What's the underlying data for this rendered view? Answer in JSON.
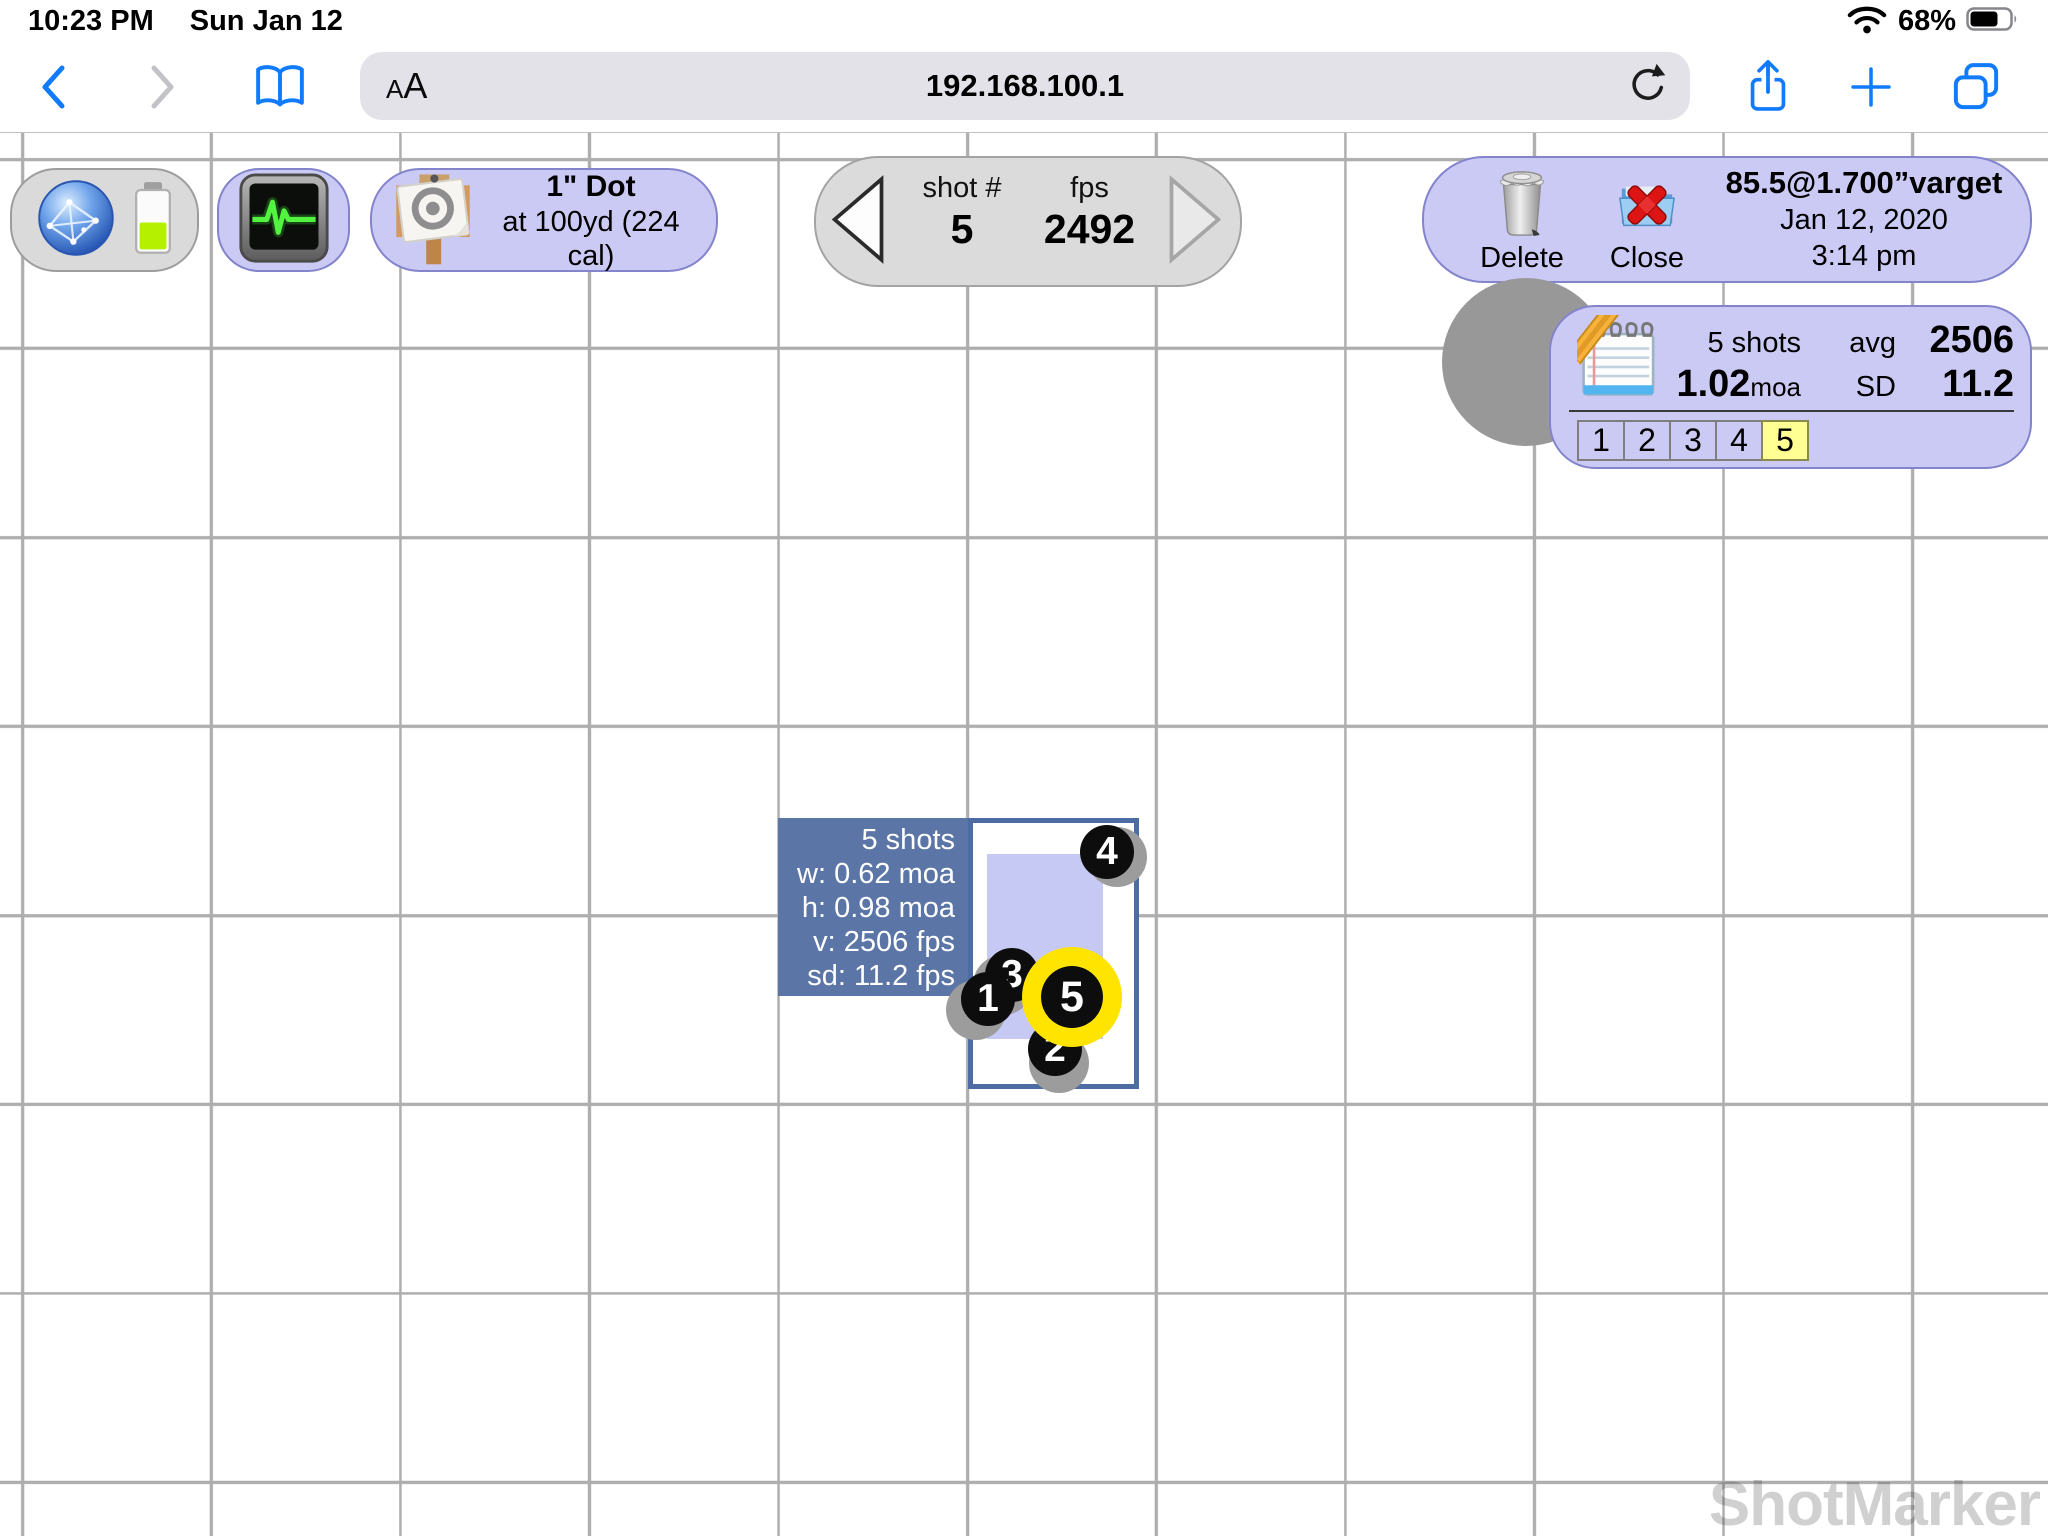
{
  "status_bar": {
    "time": "10:23 PM",
    "date": "Sun Jan 12",
    "battery_percent": "68%"
  },
  "browser_toolbar": {
    "reader_button_small": "A",
    "reader_button_large": "A",
    "url": "192.168.100.1"
  },
  "target_pill": {
    "title": "1\" Dot",
    "subtitle": "at 100yd (224 cal)"
  },
  "shot_nav": {
    "shot_label": "shot #",
    "shot_number": "5",
    "fps_label": "fps",
    "fps_value": "2492"
  },
  "session_pill": {
    "delete_label": "Delete",
    "close_label": "Close",
    "load_name": "85.5@1.700”varget",
    "date": "Jan 12, 2020",
    "time": "3:14 pm"
  },
  "stats_panel": {
    "shots_count": "5 shots",
    "avg_label": "avg",
    "avg_fps": "2506",
    "group_size": "1.02",
    "group_unit": "moa",
    "sd_label": "SD",
    "sd_value": "11.2",
    "shot_tabs": [
      "1",
      "2",
      "3",
      "4",
      "5"
    ],
    "active_tab": "5"
  },
  "plot": {
    "info_lines": [
      "5 shots",
      "w: 0.62 moa",
      "h: 0.98 moa",
      "v: 2506 fps",
      "sd: 11.2 fps"
    ],
    "group_rect": {
      "x": 19,
      "y": 36,
      "w": 116,
      "h": 185
    },
    "shots": [
      {
        "label": "4",
        "x": 139,
        "y": 34,
        "halo_dx": 10,
        "halo_dy": 5,
        "selected": false
      },
      {
        "label": "3",
        "x": 44,
        "y": 157,
        "halo_dx": -9,
        "halo_dy": 10,
        "selected": false
      },
      {
        "label": "1",
        "x": 20,
        "y": 181,
        "halo_dx": -12,
        "halo_dy": 11,
        "selected": false
      },
      {
        "label": "2",
        "x": 87,
        "y": 231,
        "halo_dx": 4,
        "halo_dy": 14,
        "selected": false
      },
      {
        "label": "5",
        "x": 104,
        "y": 179,
        "halo_dx": 0,
        "halo_dy": 0,
        "selected": true
      }
    ]
  },
  "watermark": "ShotMarker",
  "colors": {
    "accent_blue": "#0f7cfe",
    "pill_lavender": "#cbcaf4",
    "pill_border": "#8484cd",
    "info_box_blue": "#5b76a6",
    "plot_border_blue": "#4c6ca3",
    "group_rect_lavender": "#c5c9f3",
    "selected_shot_yellow": "#ffe400",
    "active_tab_yellow": "#ffff94",
    "grid_line_gray": "#aeaeae"
  }
}
